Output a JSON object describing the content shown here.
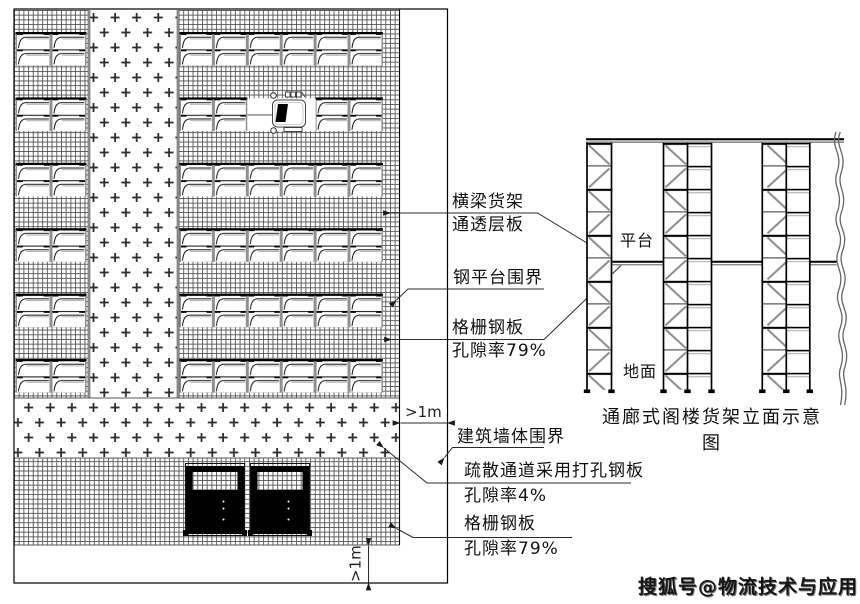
{
  "title": "通廊式阁楼货架平面及立面示意图",
  "callouts": {
    "beam_rack_line1": "横梁货架",
    "beam_rack_line2": "通透层板",
    "steel_platform_boundary": "钢平台围界",
    "grating_upper_line1": "格栅钢板",
    "grating_upper_line2": "孔隙率79%",
    "wall_boundary": "建筑墙体围界",
    "evac_line1": "疏散通道采用打孔钢板",
    "evac_line2": "孔隙率4%",
    "grating_lower_line1": "格栅钢板",
    "grating_lower_line2": "孔隙率79%"
  },
  "dimensions": {
    "corridor_width": ">1m",
    "bottom_gap": ">1m"
  },
  "elevation": {
    "platform_label": "平台",
    "ground_label": "地面",
    "caption": "通廊式阁楼货架立面示意图"
  },
  "watermark": "搜狐号@物流技术与应用",
  "colors": {
    "line": "#000000",
    "secondary_line": "#8c8c8c",
    "background": "#ffffff"
  }
}
